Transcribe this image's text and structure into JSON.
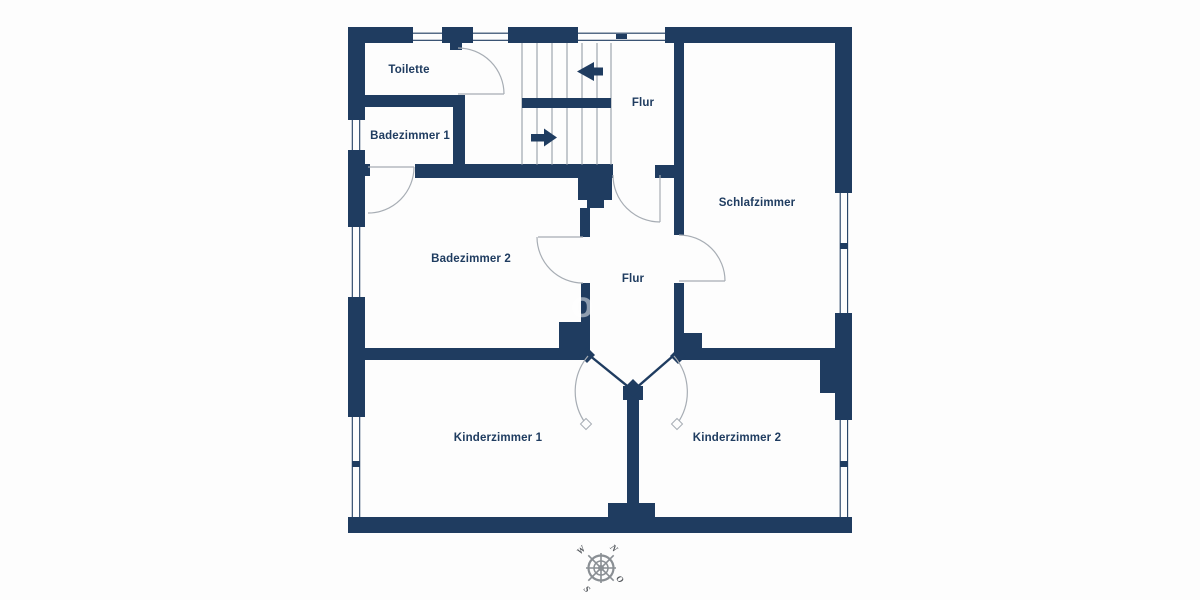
{
  "floorplan": {
    "rooms": [
      {
        "id": "toilette",
        "label": "Toilette"
      },
      {
        "id": "badezimmer-1",
        "label": "Badezimmer 1"
      },
      {
        "id": "flur-upper",
        "label": "Flur"
      },
      {
        "id": "schlafzimmer",
        "label": "Schlafzimmer"
      },
      {
        "id": "badezimmer-2",
        "label": "Badezimmer 2"
      },
      {
        "id": "flur-central",
        "label": "Flur"
      },
      {
        "id": "kinderzimmer-1",
        "label": "Kinderzimmer 1"
      },
      {
        "id": "kinderzimmer-2",
        "label": "Kinderzimmer 2"
      }
    ],
    "compass": {
      "north": "N",
      "east": "O",
      "south": "S",
      "west": "W"
    },
    "watermark": "o",
    "colors": {
      "wall": "#1f3c60",
      "background": "#fdfdfd",
      "door_arc": "#a7adb4",
      "stair_line": "#8b95a0",
      "compass": "#8a8f94",
      "label_text": "#1f3c60"
    }
  }
}
